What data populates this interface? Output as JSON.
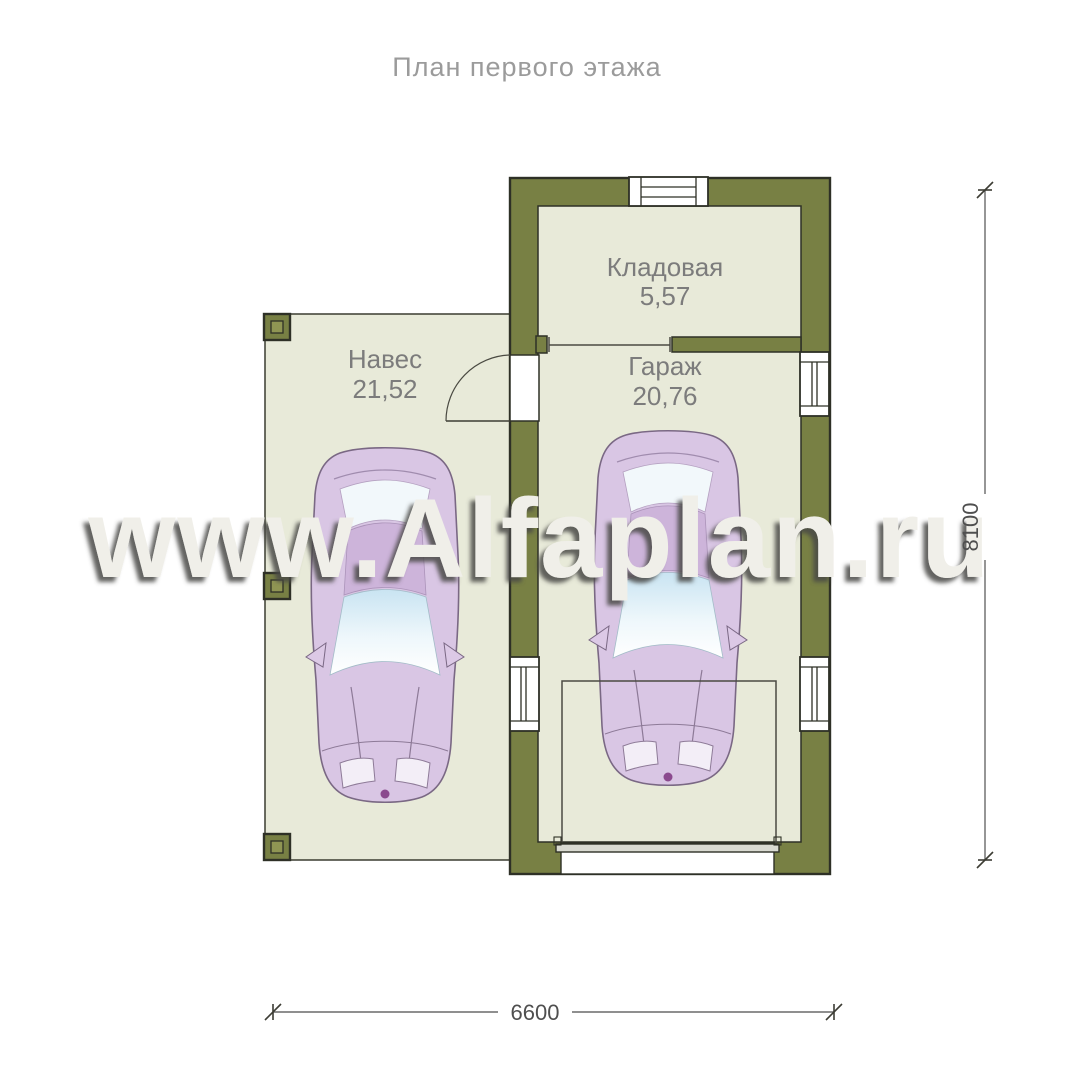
{
  "title": "План первого этажа",
  "watermark": "www.Alfaplan.ru",
  "rooms": [
    {
      "name": "Кладовая",
      "area": "5,57"
    },
    {
      "name": "Гараж",
      "area": "20,76"
    },
    {
      "name": "Навес",
      "area": "21,52"
    }
  ],
  "dimensions": {
    "overall_width_mm": "6600",
    "overall_height_mm": "8100"
  },
  "colors": {
    "background": "#ffffff",
    "wall": "#788044",
    "wall_outline": "#2e3026",
    "floor": "#e8ead9",
    "column_inner": "#8f9553",
    "car_body": "#d9c6e4",
    "car_roof": "#cdb4da",
    "car_glass": "#d6ecf6",
    "watermark": "#f0efe9",
    "title_text": "#9b9b9b",
    "label_text": "#7c7c7c",
    "dimension_text": "#4f4f4f"
  }
}
